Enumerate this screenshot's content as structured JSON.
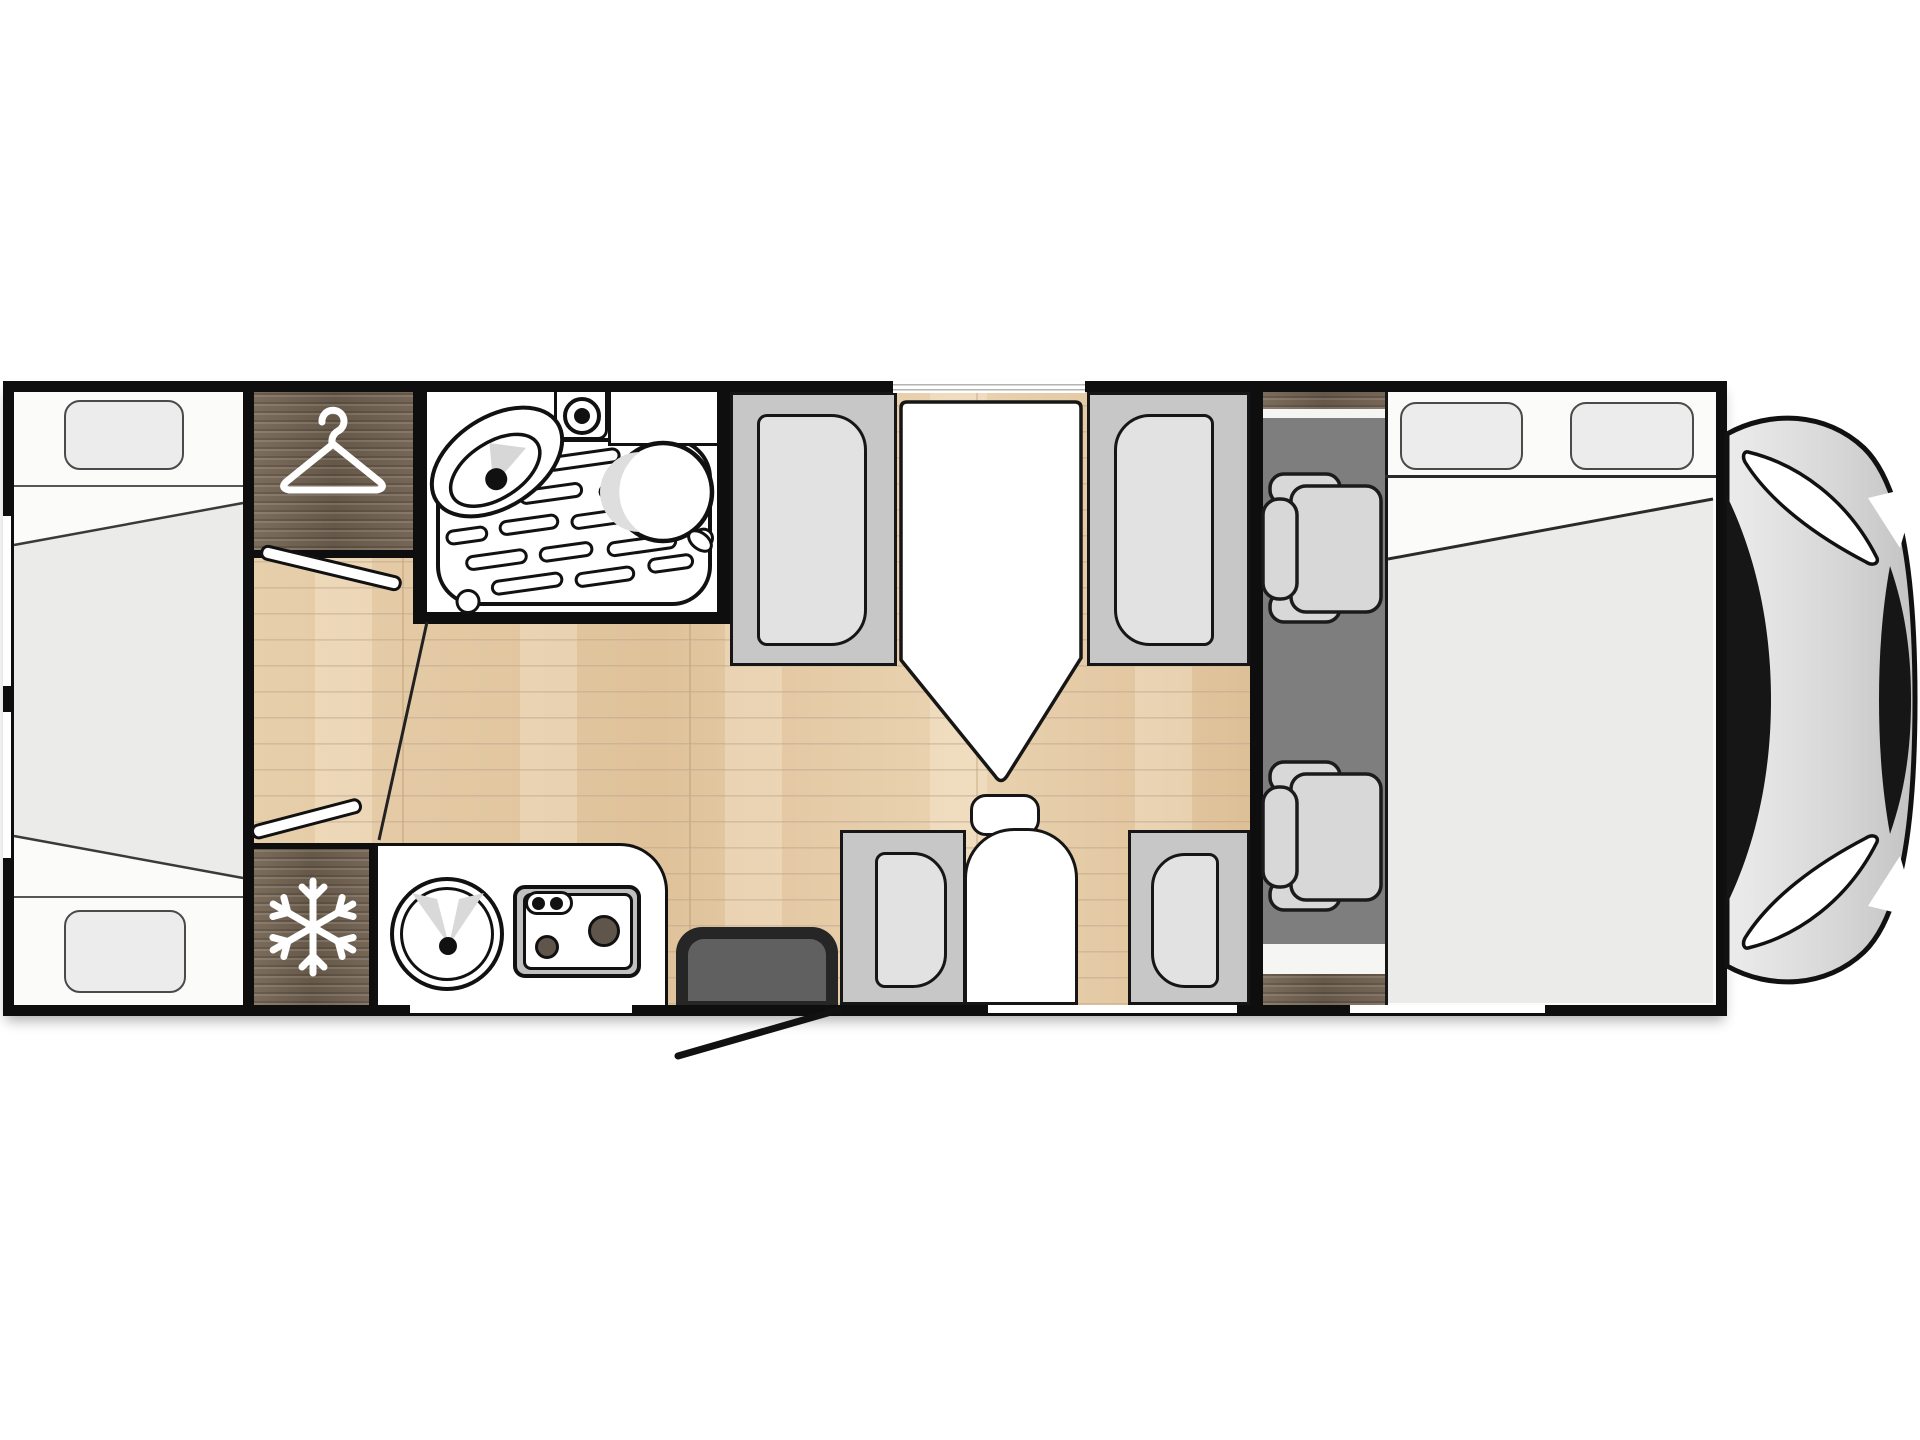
{
  "page": {
    "title": "Motorhome floor plan — top view",
    "type": "floor-plan-diagram",
    "visible_text": []
  },
  "colors": {
    "background": "#ffffff",
    "wall": "#0e0e0e",
    "wood_floor": "#e2c8a2",
    "dark_wood_furniture": "#6f6050",
    "bench_frame": "#c7c7c7",
    "seat_cushion": "#e2e2e2",
    "cab_carpet": "#7e7e7e",
    "mattress_gray": "#ebebea",
    "white_surface": "#ffffff",
    "cab_seat_gray": "#d8d8d8",
    "vehicle_nose_gray": "#d6d6d6",
    "entry_door_dark": "#262626"
  },
  "zones": [
    {
      "id": "rear-bed",
      "label": "Rear bed with two pillows"
    },
    {
      "id": "wardrobe",
      "label": "Wardrobe",
      "icon": "hanger-icon"
    },
    {
      "id": "bathroom",
      "label": "Bathroom with shower tray, washbasin, faucet and toilet"
    },
    {
      "id": "fridge",
      "label": "Refrigerator",
      "icon": "snowflake-icon"
    },
    {
      "id": "kitchen",
      "label": "Kitchen block with round sink and two-burner hob"
    },
    {
      "id": "dinette",
      "label": "Dinette: table, two facing bench seats and side seat"
    },
    {
      "id": "entry-door",
      "label": "Entry door shown open"
    },
    {
      "id": "cab-seats",
      "label": "Driver and passenger cab seats on carpet"
    },
    {
      "id": "front-bed",
      "label": "Front double bed with two pillows"
    },
    {
      "id": "cab-nose",
      "label": "Vehicle cab front with windshield"
    }
  ],
  "icons": [
    "hanger-icon",
    "snowflake-icon"
  ]
}
